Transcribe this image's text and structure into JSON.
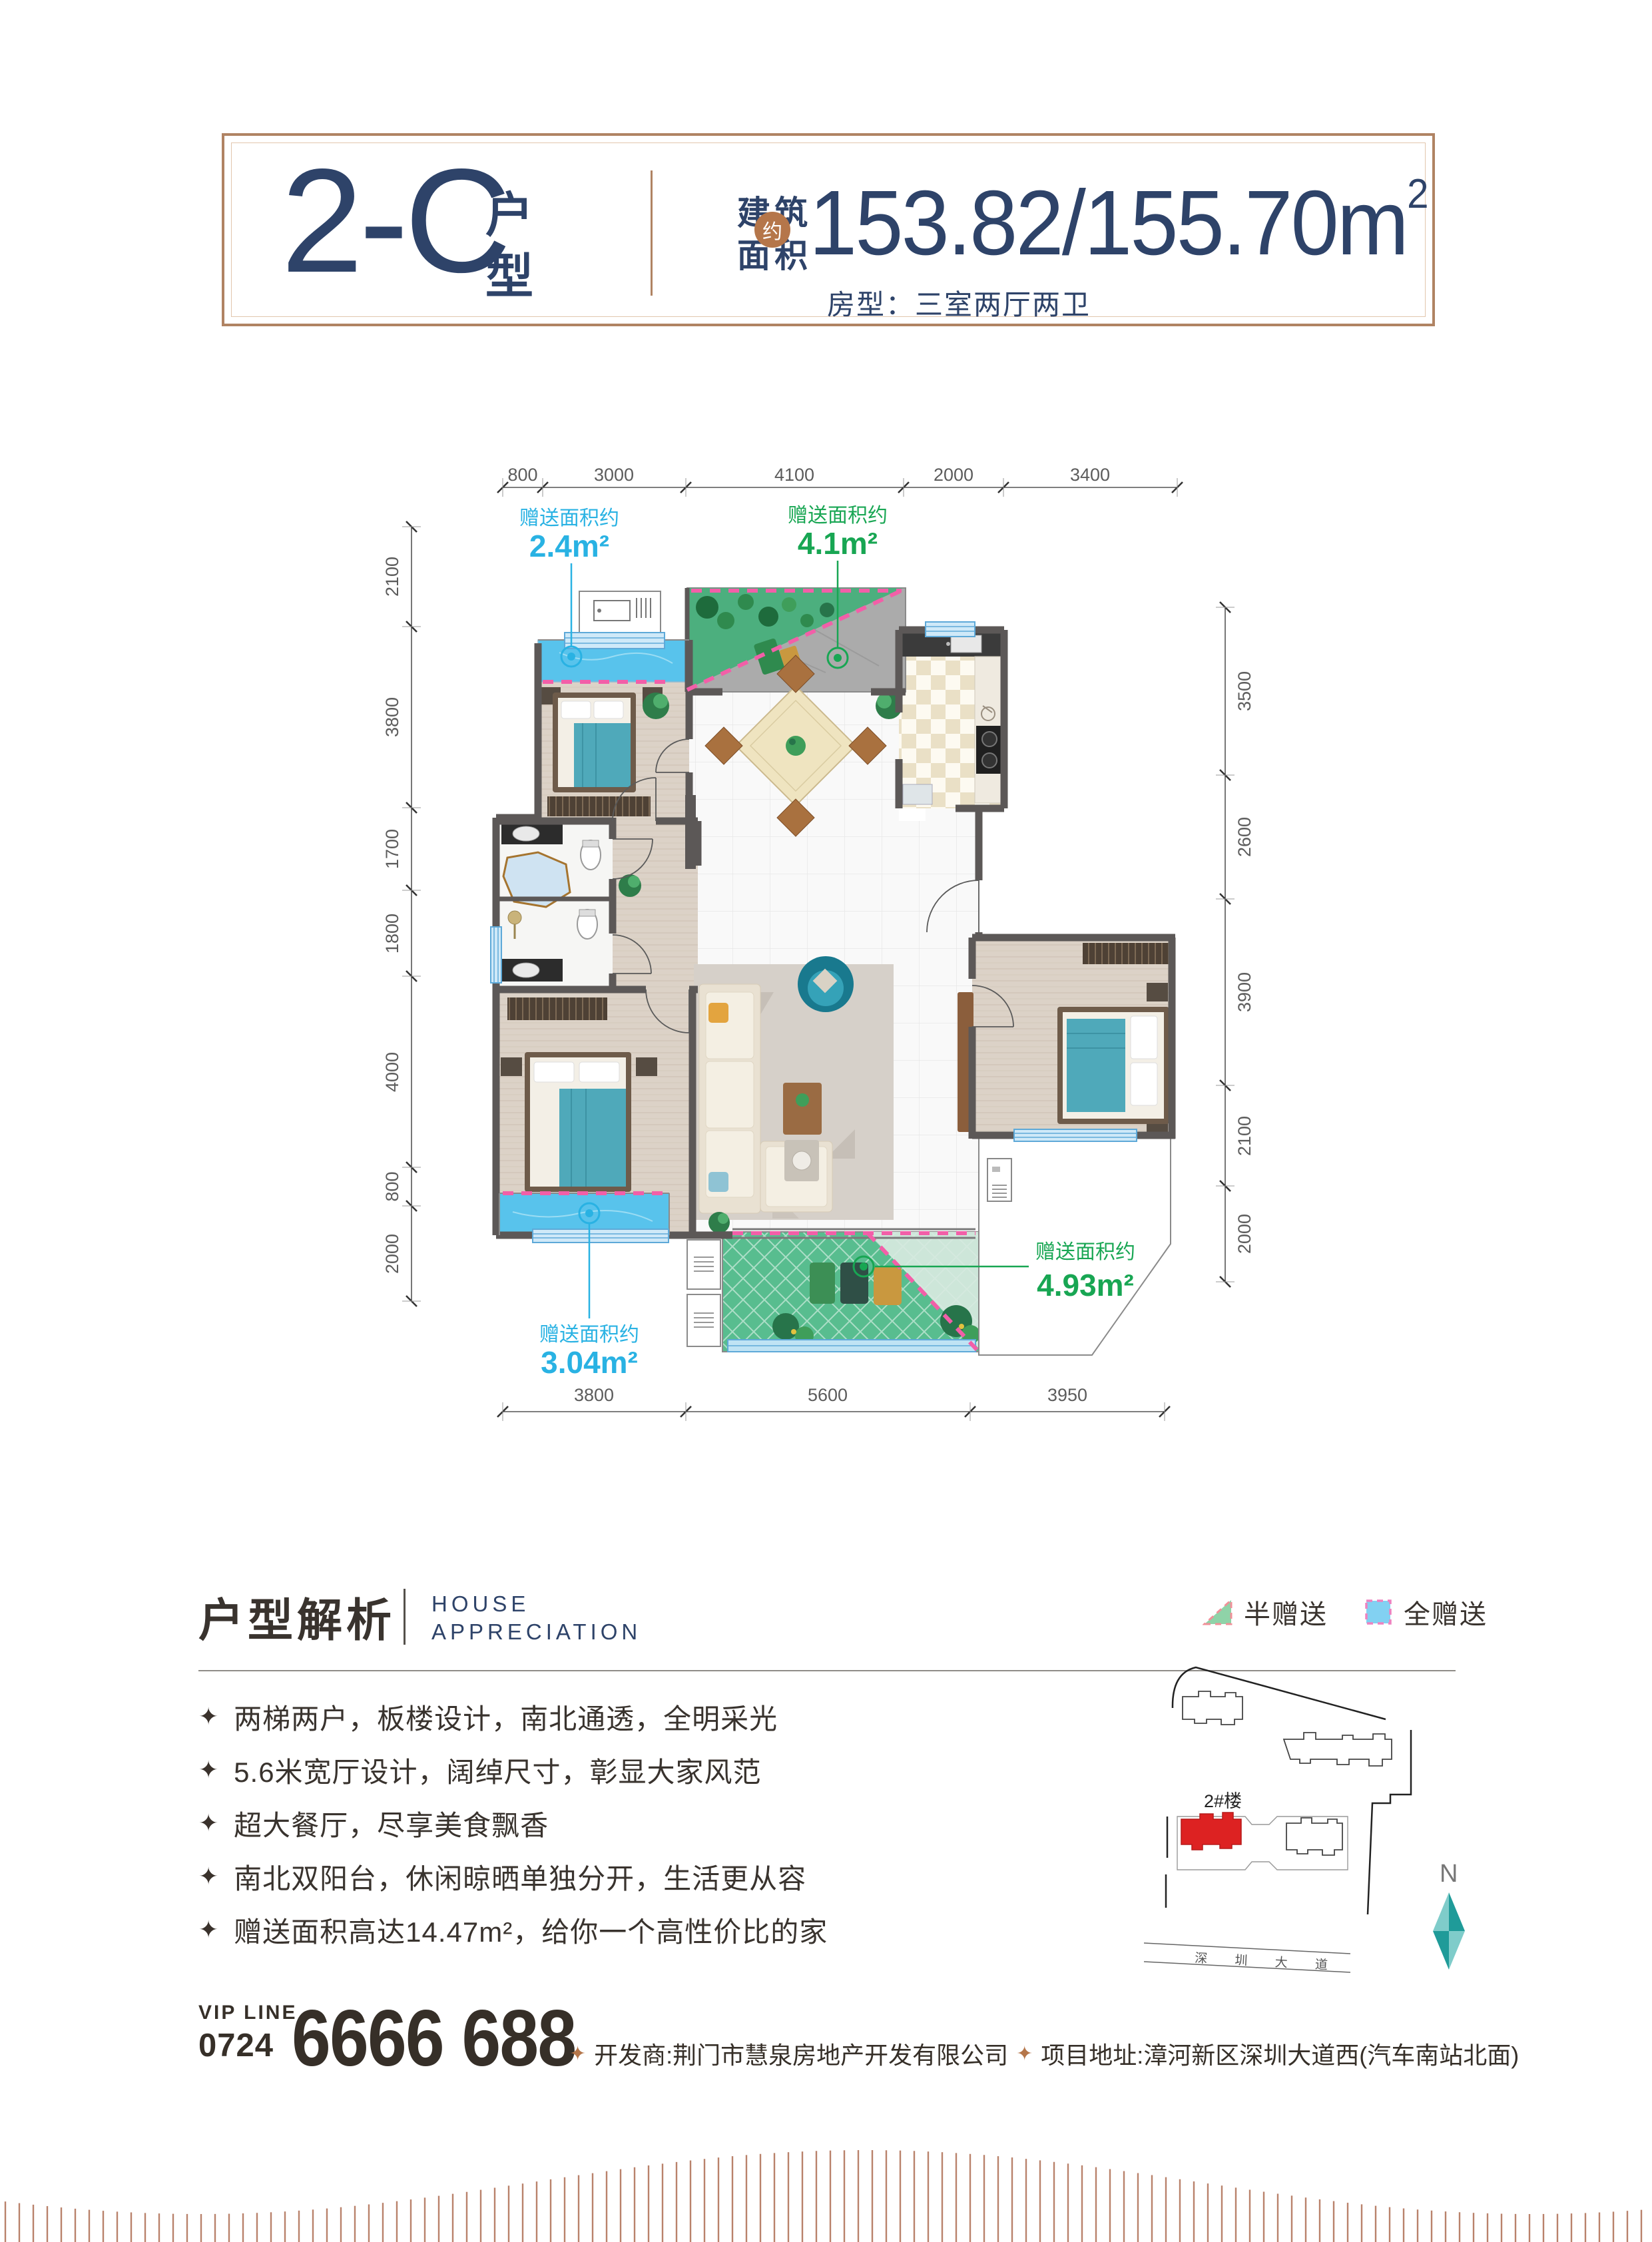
{
  "colors": {
    "navy": "#2e4369",
    "copper": "#b08363",
    "badge_copper": "#b5764a",
    "cyan_label": "#29b2e3",
    "green_label": "#18a653",
    "dash_pink": "#f25fa8",
    "full_gift_blue": "#58c3ec",
    "half_gift_green": "#4caf7e",
    "wall_gray": "#5c5857",
    "site_red": "#dd2222",
    "compass_teal": "#1f9b99"
  },
  "header": {
    "type_code": "2-C",
    "type_label": "户型",
    "area_prefix_line1": "建筑",
    "area_prefix_line2": "面积",
    "approx_badge": "约",
    "area_value": "153.82/155.70m",
    "area_sup": "2",
    "layout_info": "房型：三室两厅两卫"
  },
  "floorplan": {
    "dims_top": [
      "800",
      "3000",
      "4100",
      "2000",
      "3400"
    ],
    "dims_left": [
      "2100",
      "3800",
      "1700",
      "1800",
      "4000",
      "800",
      "2000"
    ],
    "dims_right": [
      "3500",
      "2600",
      "3900",
      "2100",
      "2000"
    ],
    "dims_bottom": [
      "3800",
      "5600",
      "3950"
    ],
    "gift_areas": [
      {
        "label": "赠送面积约",
        "value": "2.4m²",
        "type": "full"
      },
      {
        "label": "赠送面积约",
        "value": "4.1m²",
        "type": "half"
      },
      {
        "label": "赠送面积约",
        "value": "3.04m²",
        "type": "full"
      },
      {
        "label": "赠送面积约",
        "value": "4.93m²",
        "type": "half"
      }
    ]
  },
  "analysis": {
    "title": "户型解析",
    "subtitle_line1": "HOUSE",
    "subtitle_line2": "APPRECIATION",
    "bullet_icon": "✦",
    "bullets": [
      "两梯两户，板楼设计，南北通透，全明采光",
      "5.6米宽厅设计，阔绰尺寸，彰显大家风范",
      "超大餐厅，尽享美食飘香",
      "南北双阳台，休闲晾晒单独分开，生活更从容",
      "赠送面积高达14.47m²，给你一个高性价比的家"
    ]
  },
  "legend": {
    "half_label": "半赠送",
    "full_label": "全赠送"
  },
  "sitemap": {
    "building_label": "2#楼",
    "road_label": "深 圳 大 道",
    "north_label": "N"
  },
  "footer": {
    "vip_label": "VIP LINE",
    "vip_area_code": "0724",
    "vip_number": "6666 688",
    "bullet_icon": "✦",
    "developer": "开发商:荆门市慧泉房地产开发有限公司",
    "address": "项目地址:漳河新区深圳大道西(汽车南站北面)"
  }
}
